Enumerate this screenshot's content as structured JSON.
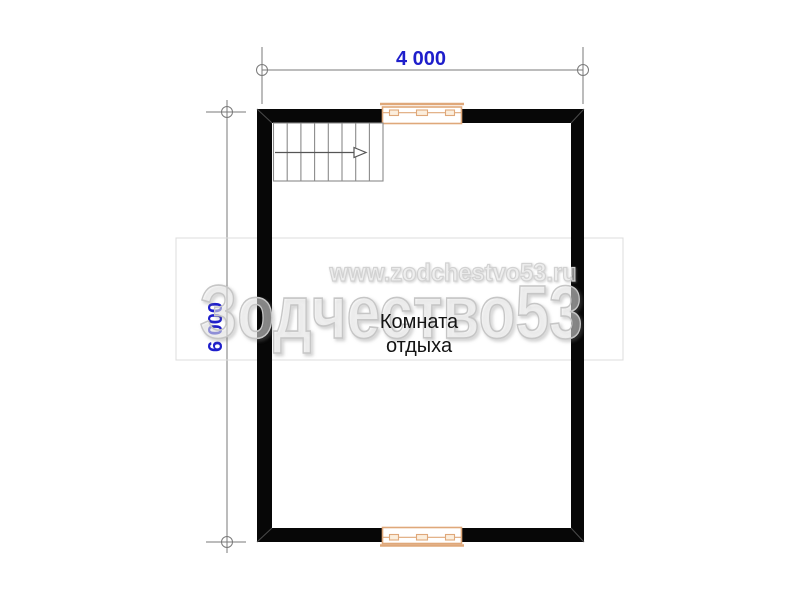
{
  "page": {
    "type": "architectural-floor-plan",
    "background": "#ffffff"
  },
  "dimensions": {
    "top": {
      "label": "4 000"
    },
    "left": {
      "label": "6 000"
    }
  },
  "room": {
    "name": "Комната отдыха",
    "line1": "Комната",
    "line2": "отдыха"
  },
  "watermark": {
    "url": "www.zodchestvo53.ru",
    "brand": "Зодчество53"
  },
  "colors": {
    "wall_black": "#070707",
    "dimension_line_gray": "#7a7a7a",
    "dimension_text_blue": "#1e1ecb",
    "window_tan": "#dfa87a",
    "window_fill": "#fbeedd",
    "stair_gray": "#8a8a8a",
    "watermark_gray": "#c6c6c6",
    "room_text": "#141414"
  }
}
